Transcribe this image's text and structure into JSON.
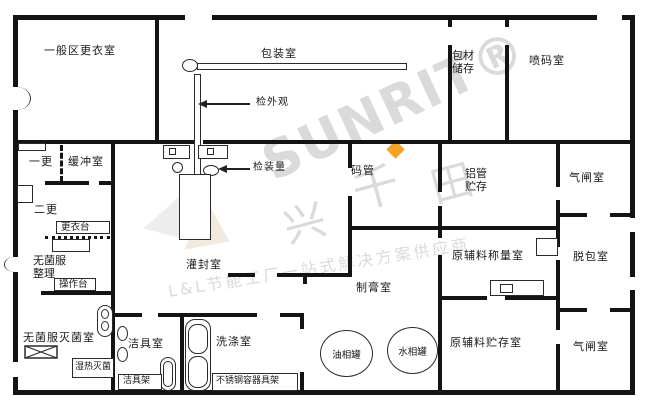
{
  "watermark": {
    "brand": "SUNRIT®",
    "cjk_1": "兴",
    "cjk_2": "千",
    "cjk_3": "田",
    "slogan": "L&L节能工厂一站式解决方案供应商",
    "gray": "#dadada",
    "accent_diamond": "#f5a325"
  },
  "rooms": {
    "general_changing": "一般区更衣室",
    "packaging": "包装室",
    "material_storage": "包材储存",
    "coding": "喷码室",
    "first_change": "一更",
    "buffer": "缓冲室",
    "second_change": "二更",
    "sterile_sorting": "无菌服整理",
    "sterile_sterilization": "无菌服灭菌室",
    "cleaning_tools": "洁具室",
    "washing": "洗涤室",
    "filling_sealing": "灌封室",
    "tube_stacking": "码管",
    "aluminum_tube_storage": "铝管贮存",
    "airlock_top": "气闸室",
    "depacking": "脱包室",
    "raw_material_weighing": "原辅料称量室",
    "raw_material_storage": "原辅料贮存室",
    "airlock_bottom": "气闸室",
    "paste_making": "制膏室"
  },
  "fixtures": {
    "changing_bench": "更衣台",
    "operating_bench": "操作台",
    "moist_heat_sterilizer": "湿热灭菌",
    "cleaning_tool_rack": "洁具架",
    "stainless_container_rack": "不锈钢容器具架",
    "oil_phase_tank": "油相罐",
    "water_phase_tank": "水相罐"
  },
  "annotations": {
    "check_appearance": "检外观",
    "check_fill_volume": "检装量"
  }
}
